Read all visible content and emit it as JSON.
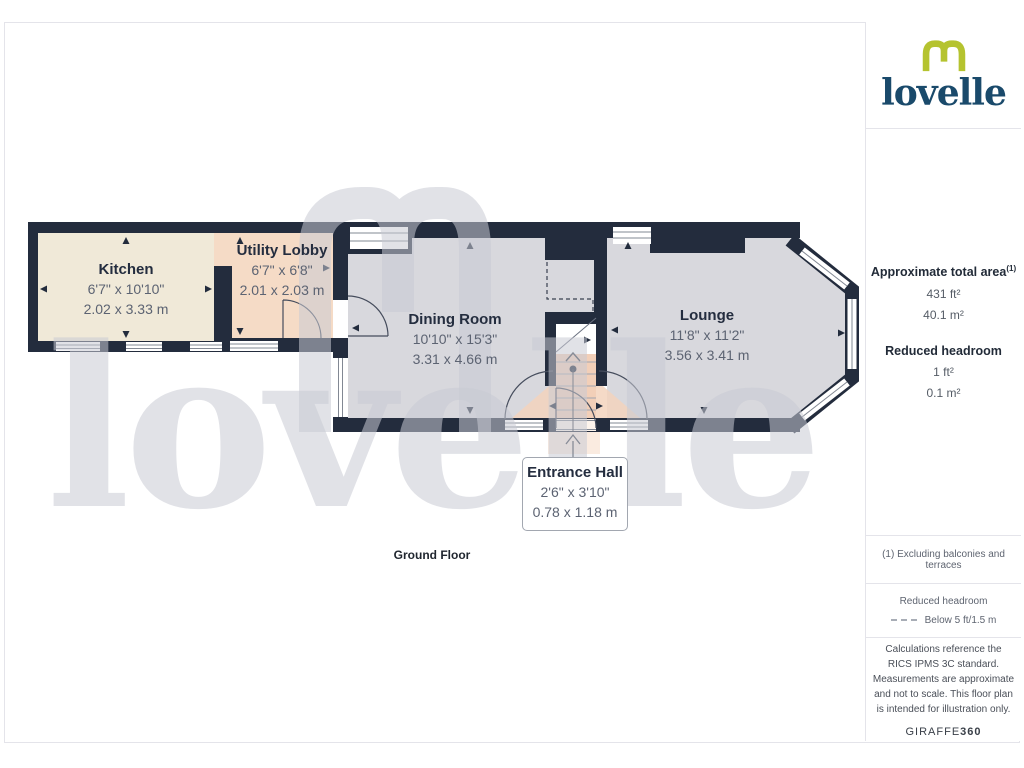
{
  "brand": {
    "logo_text": "lovelle",
    "watermark_text": "lovelle",
    "logo_green": "#b5c32f",
    "logo_navy": "#1a4a6b"
  },
  "sidebar": {
    "area_title": "Approximate total area",
    "area_sup": "(1)",
    "area_ft": "431 ft²",
    "area_m": "40.1 m²",
    "rh_title": "Reduced headroom",
    "rh_ft": "1 ft²",
    "rh_m": "0.1 m²",
    "footnote": "(1) Excluding balconies and terraces",
    "legend_title": "Reduced headroom",
    "legend_item": "Below 5 ft/1.5 m",
    "disclaimer": "Calculations reference the RICS IPMS 3C standard. Measurements are approximate and not to scale. This floor plan is intended for illustration only.",
    "credit_normal": "GIRAFFE",
    "credit_bold": "360"
  },
  "plan": {
    "floor_label": "Ground Floor",
    "rooms": [
      {
        "name": "Kitchen",
        "imperial": "6'7\" x 10'10\"",
        "metric": "2.02 x 3.33 m"
      },
      {
        "name": "Utility Lobby",
        "imperial": "6'7\" x 6'8\"",
        "metric": "2.01 x 2.03 m"
      },
      {
        "name": "Dining Room",
        "imperial": "10'10\" x 15'3\"",
        "metric": "3.31 x 4.66 m"
      },
      {
        "name": "Lounge",
        "imperial": "11'8\" x 11'2\"",
        "metric": "3.56 x 3.41 m"
      },
      {
        "name": "Entrance Hall",
        "imperial": "2'6\" x 3'10\"",
        "metric": "0.78 x 1.18 m"
      }
    ],
    "colors": {
      "wall": "#232c3d",
      "kitchen_fill": "#f0e9d8",
      "reduced_headroom_fill": "#f5dbc6",
      "room_fill": "#d8d8dd",
      "watermark": "#c9cad3"
    }
  }
}
